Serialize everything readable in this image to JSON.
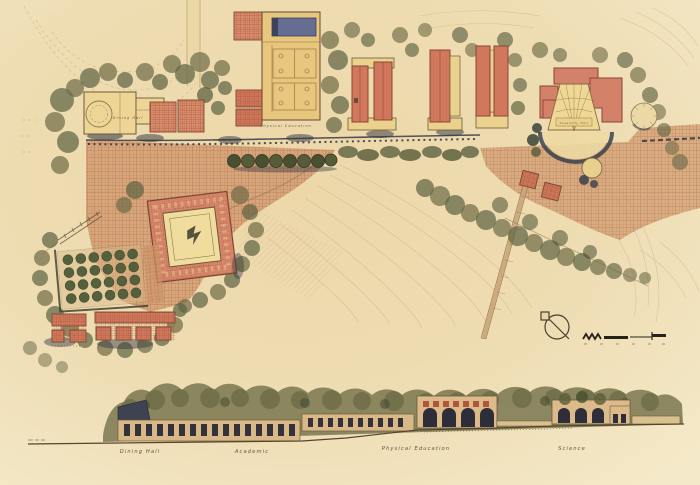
{
  "plan": {
    "labels": {
      "dining_hall": "Dining Hall",
      "physical_education": "Physical Education",
      "assembly_hall": "Assembly Hall"
    }
  },
  "section": {
    "labels": {
      "dining_hall": "Dining Hall",
      "academic": "Academic",
      "physical_education": "Physical Education",
      "science": "Science"
    }
  },
  "palette": {
    "paper": "#eedcb2",
    "paving": "#cf9a6e",
    "paving_line": "#b05a40",
    "building_cream": "#ecd18c",
    "building_red": "#d0775c",
    "pool_blue": "#666d93",
    "tree_olive": "#6e6b46",
    "tree_dark": "#49502f",
    "shadow_navy": "#2e3440",
    "ink": "#4a3a28",
    "contour": "#c3aa7c"
  }
}
